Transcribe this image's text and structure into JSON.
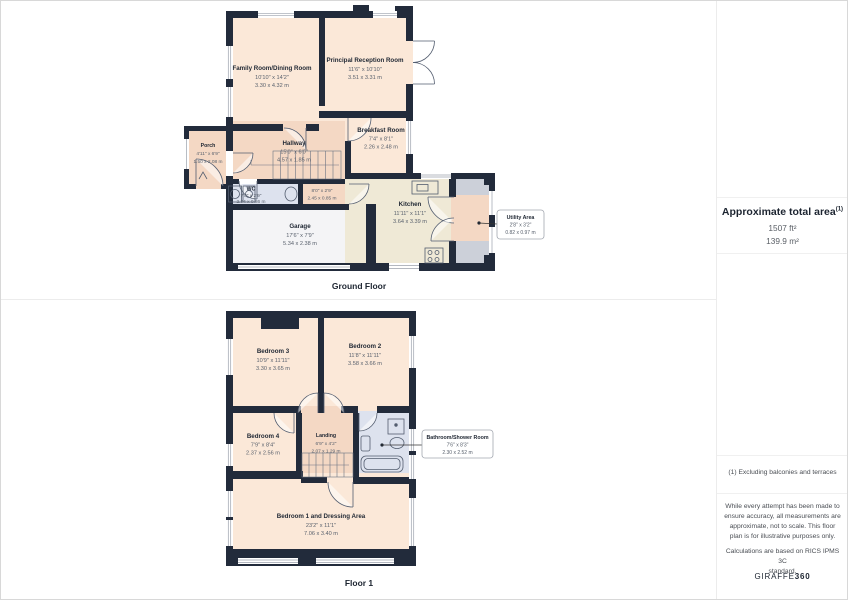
{
  "summary": {
    "title": "Approximate total area",
    "title_sup": "(1)",
    "area_ft": "1507 ft²",
    "area_m": "139.9 m²"
  },
  "footnotes": {
    "exclusion": "(1) Excluding balconies and terraces",
    "disclaimer_lines": [
      "While every attempt has been made to",
      "ensure accuracy, all measurements are",
      "approximate, not to scale. This floor",
      "plan is for illustrative purposes only."
    ],
    "standard_lines": [
      "Calculations are based on RICS IPMS 3C",
      "standard."
    ],
    "brand_name": "GIRAFFE",
    "brand_suffix": "360"
  },
  "ground_floor": {
    "label": "Ground Floor",
    "rooms": {
      "family": {
        "name": "Family Room/Dining Room",
        "imperial": "10'10\" x 14'2\"",
        "metric": "3.30 x 4.32 m"
      },
      "reception": {
        "name": "Principal Reception Room",
        "imperial": "11'6\" x 10'10\"",
        "metric": "3.51 x 3.31 m"
      },
      "breakfast": {
        "name": "Breakfast Room",
        "imperial": "7'4\" x 8'1\"",
        "metric": "2.26 x 2.48 m"
      },
      "porch": {
        "name": "Porch",
        "imperial": "4'11\" x 6'9\"",
        "metric": "1.50 x 2.08 m"
      },
      "hallway": {
        "name": "Hallway",
        "imperial": "15'0\" x 6'0\"",
        "metric": "4.57 x 1.85 m"
      },
      "wc": {
        "name": "WC",
        "imperial": "7'8\" x 2'9\"",
        "metric": "2.34 x 0.86 m"
      },
      "inner_hall": {
        "imperial": "8'0\" x 2'9\"",
        "metric": "2.45 x 0.85 m"
      },
      "garage": {
        "name": "Garage",
        "imperial": "17'6\" x 7'9\"",
        "metric": "5.34 x 2.38 m"
      },
      "kitchen": {
        "name": "Kitchen",
        "imperial": "11'11\" x 11'1\"",
        "metric": "3.64 x 3.39 m"
      },
      "utility": {
        "name": "Utility Area",
        "imperial": "2'8\" x 3'2\"",
        "metric": "0.82 x 0.97 m"
      }
    }
  },
  "floor1": {
    "label": "Floor 1",
    "rooms": {
      "bedroom3": {
        "name": "Bedroom 3",
        "imperial": "10'9\" x 11'11\"",
        "metric": "3.30 x 3.65 m"
      },
      "bedroom2": {
        "name": "Bedroom 2",
        "imperial": "11'8\" x 11'11\"",
        "metric": "3.58 x 3.66 m"
      },
      "bedroom4": {
        "name": "Bedroom 4",
        "imperial": "7'9\" x 8'4\"",
        "metric": "2.37 x 2.56 m"
      },
      "landing": {
        "name": "Landing",
        "imperial": "6'9\" x 4'2\"",
        "metric": "2.07 x 1.29 m"
      },
      "bathroom": {
        "name": "Bathroom/Shower Room",
        "imperial": "7'6\" x 8'3\"",
        "metric": "2.30 x 2.52 m"
      },
      "bedroom1": {
        "name": "Bedroom 1 and Dressing Area",
        "imperial": "23'2\" x 11'1\"",
        "metric": "7.06 x 3.40 m"
      }
    }
  },
  "colors": {
    "wall": "#222b3b",
    "room": "#fbe8d8",
    "hall": "#f4d8c4",
    "kitchen": "#efe9d6",
    "garage": "#f4f4f6",
    "wet_room": "#dde2ee",
    "utility_floor": "#ccd0d9"
  }
}
